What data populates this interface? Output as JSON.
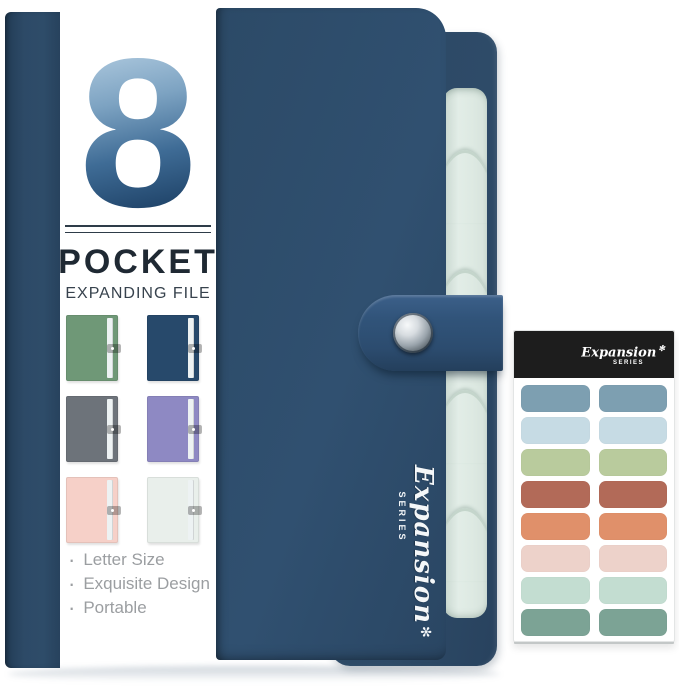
{
  "product": {
    "logo_number": "8",
    "title": "POCKET",
    "subtitle": "EXPANDING FILE",
    "series_script": "Expansion",
    "series_label": "SERIES",
    "star_glyph": "✻",
    "bullet_glyph": "·",
    "features": [
      "Letter Size",
      "Exquisite Design",
      "Portable"
    ],
    "colors": {
      "navy_front": "#2e4c69",
      "navy_spine": "#2a4663",
      "navy_back": "#2c4965",
      "strap": "#31547a",
      "pocket_edge": "#dde9e2",
      "pocket_edge_shadow": "#c4d5cb",
      "label_bg": "#ffffff",
      "logo_gradient_top": "#abc7dd",
      "logo_gradient_bottom": "#1c3f64",
      "thumb_strip": "#edf2f3",
      "feature_text": "#9b9ea1"
    }
  },
  "swatches": [
    {
      "name": "green",
      "color": "#6f9877"
    },
    {
      "name": "navy",
      "color": "#27496b"
    },
    {
      "name": "gray",
      "color": "#6d737a"
    },
    {
      "name": "purple",
      "color": "#8e89c3"
    },
    {
      "name": "pink",
      "color": "#f6d0c8"
    },
    {
      "name": "mint",
      "color": "#e9efeb"
    }
  ],
  "sticker_sheet": {
    "header_bg": "#1d1d1d",
    "script": "Expansion",
    "series_label": "SERIES",
    "colors": [
      "#7d9fb1",
      "#c6dbe4",
      "#b9cb9d",
      "#b26a58",
      "#e0906a",
      "#edd2ca",
      "#c3ddd1",
      "#7ca395"
    ]
  }
}
